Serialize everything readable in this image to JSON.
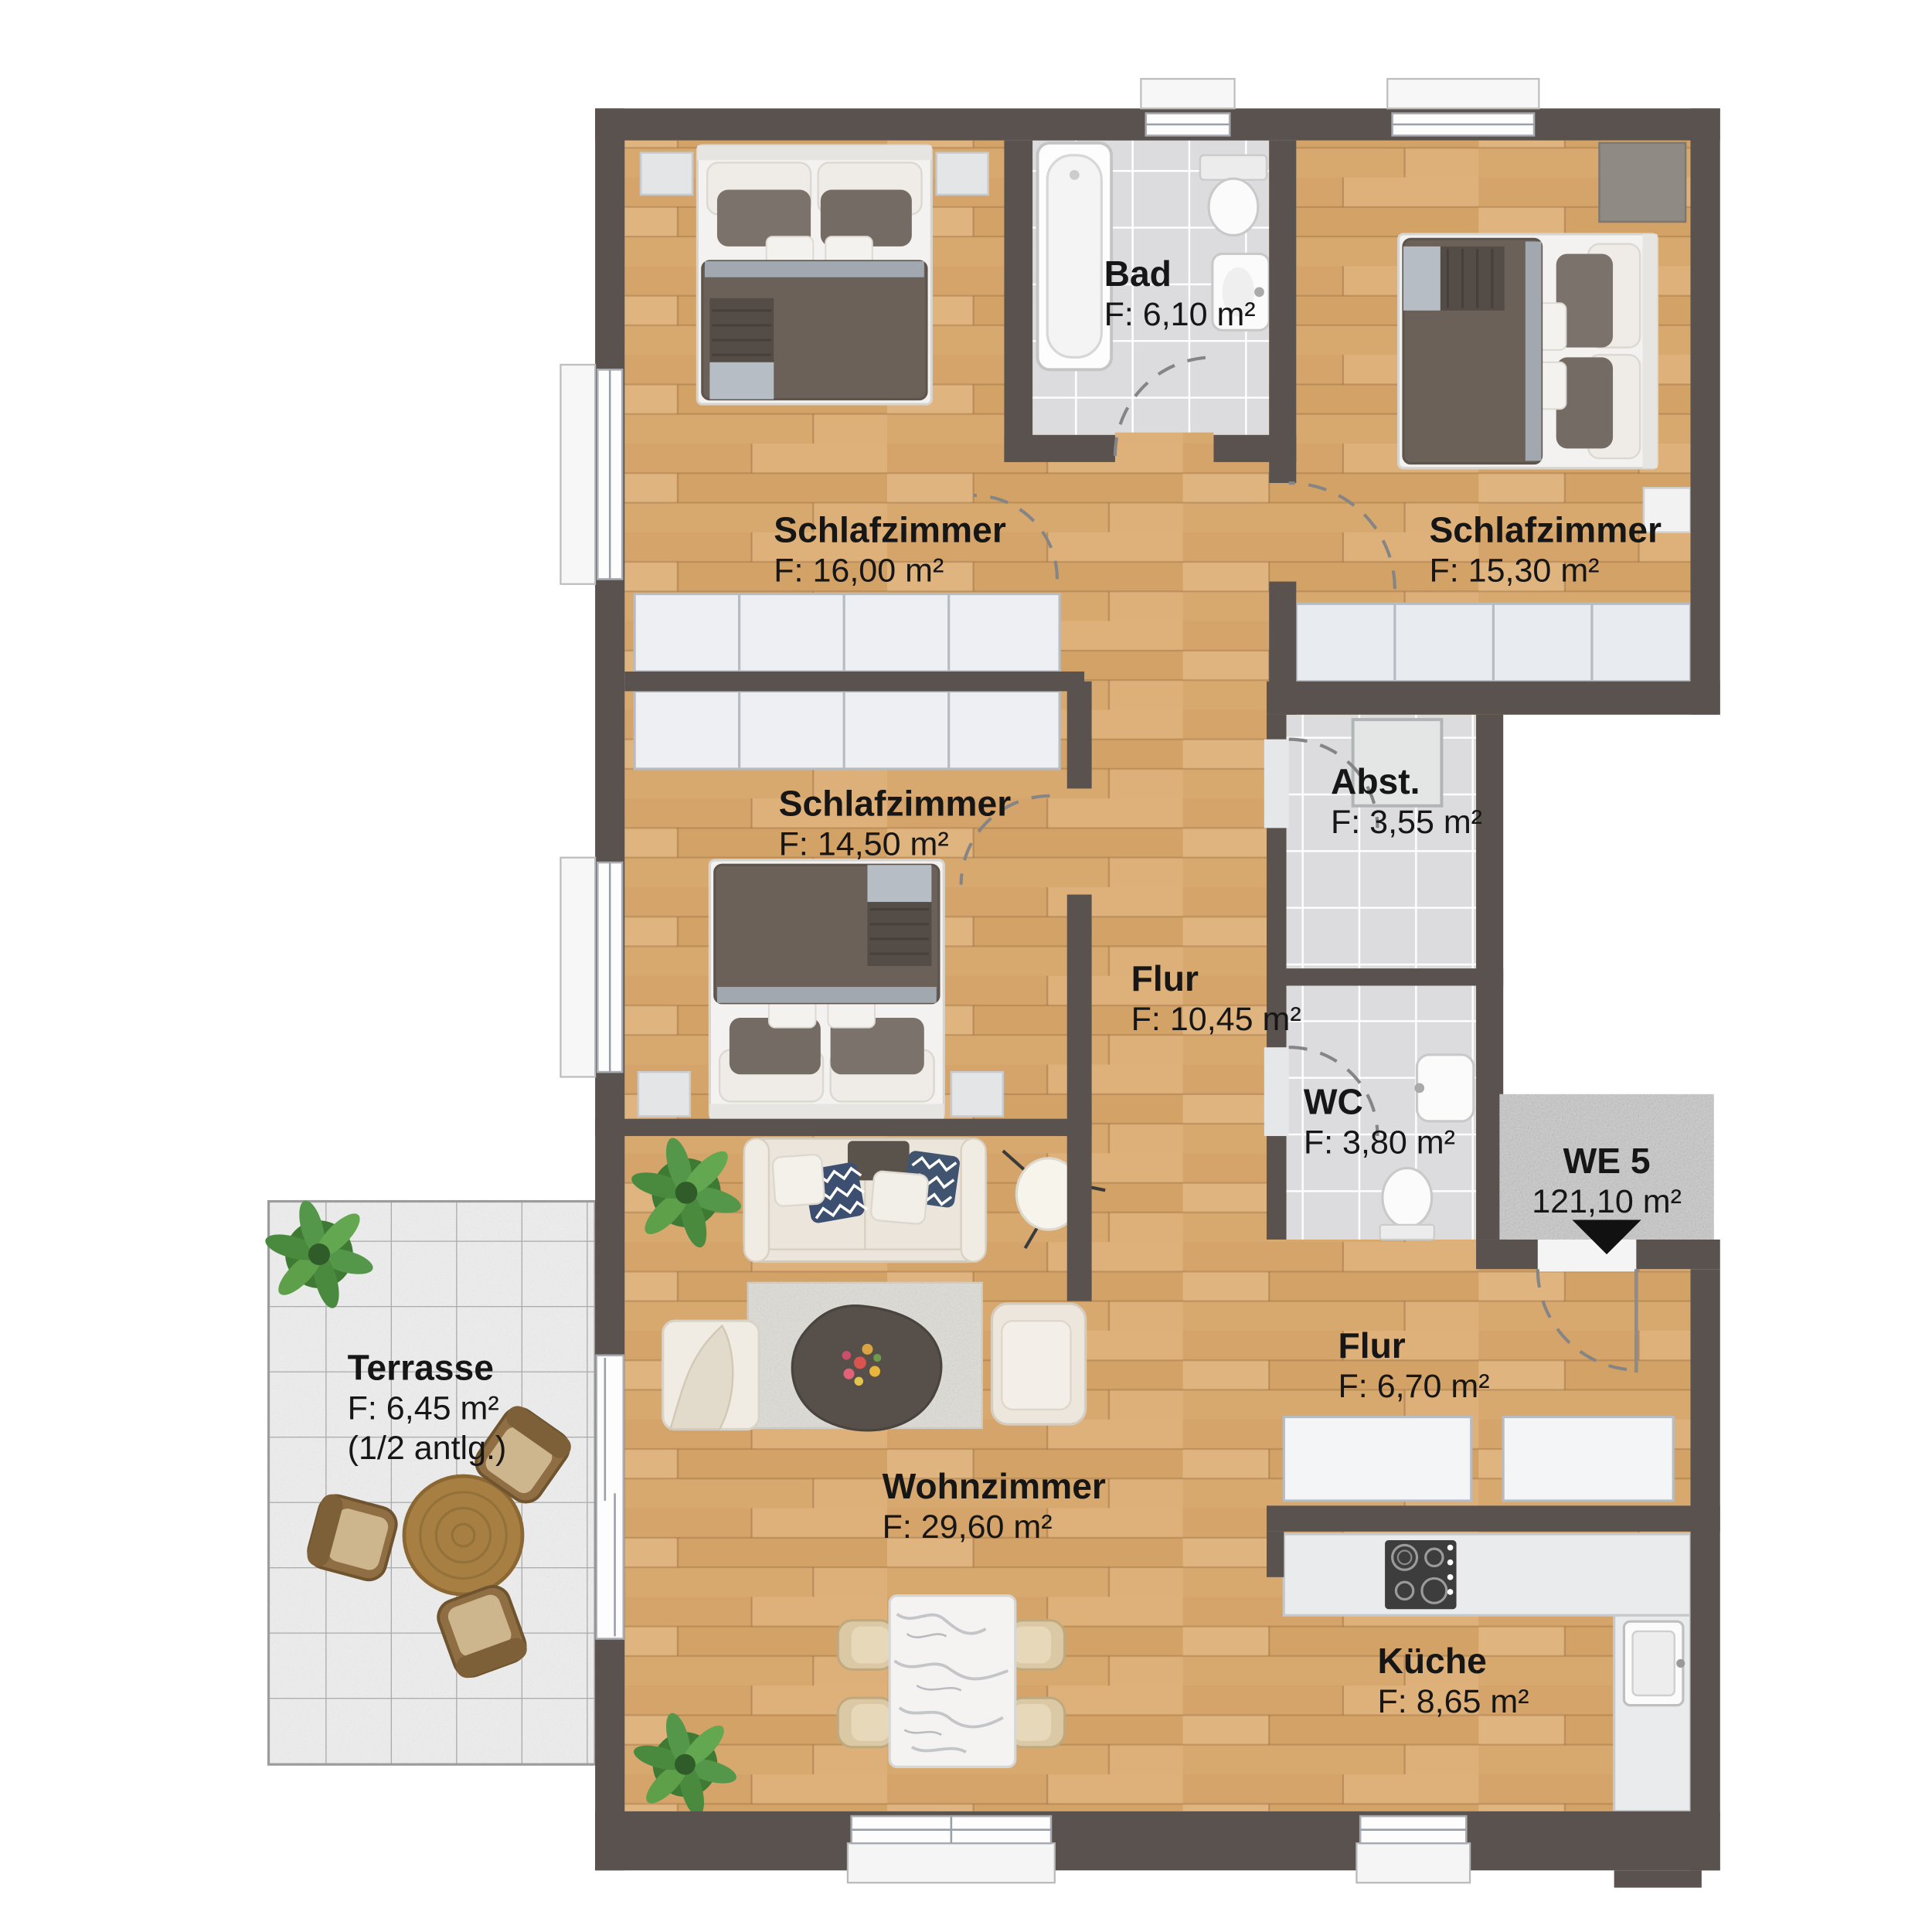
{
  "unit": {
    "name": "WE 5",
    "area": "121,10 m²"
  },
  "rooms": {
    "bad": {
      "name": "Bad",
      "area": "F: 6,10 m²"
    },
    "schlafzimmer1": {
      "name": "Schlafzimmer",
      "area": "F: 16,00 m²"
    },
    "schlafzimmer2": {
      "name": "Schlafzimmer",
      "area": "F: 15,30 m²"
    },
    "schlafzimmer3": {
      "name": "Schlafzimmer",
      "area": "F: 14,50 m²"
    },
    "abstellraum": {
      "name": "Abst.",
      "area": "F: 3,55 m²"
    },
    "flur1": {
      "name": "Flur",
      "area": "F: 10,45 m²"
    },
    "wc": {
      "name": "WC",
      "area": "F: 3,80 m²"
    },
    "flur2": {
      "name": "Flur",
      "area": "F: 6,70 m²"
    },
    "terrasse": {
      "name": "Terrasse",
      "area": "F: 6,45 m²",
      "note": "(1/2 antlg.)"
    },
    "wohnzimmer": {
      "name": "Wohnzimmer",
      "area": "F: 29,60 m²"
    },
    "kueche": {
      "name": "Küche",
      "area": "F: 8,65 m²"
    }
  },
  "colors": {
    "wall": "#5a524e",
    "wood": "#d9ab72",
    "tile": "#dcdcdf",
    "terrace_tile": "#ededed",
    "landing": "#c8c8c8",
    "label_text": "#161616"
  }
}
